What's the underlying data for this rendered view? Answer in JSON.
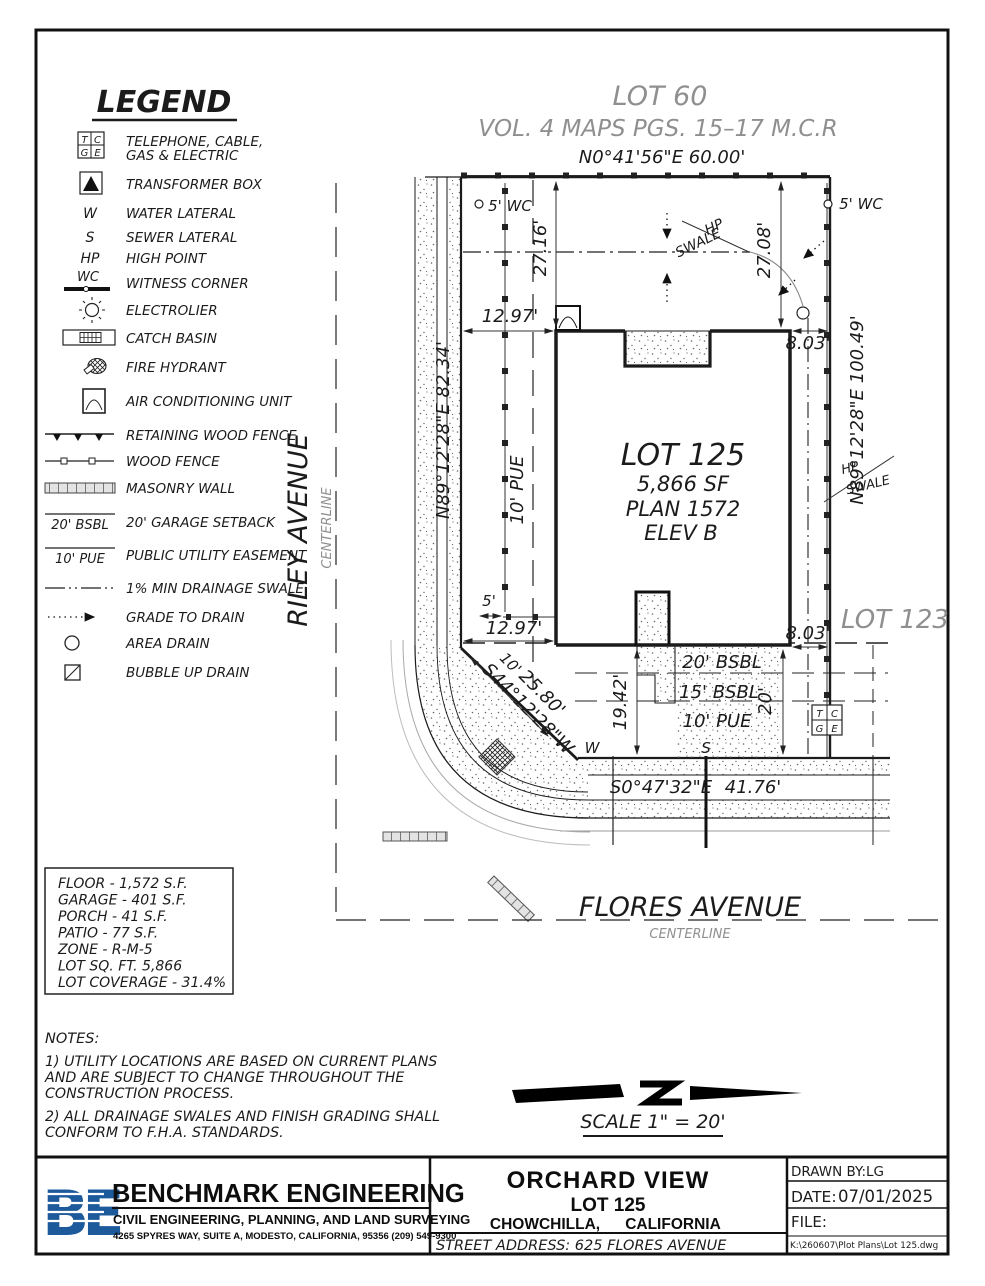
{
  "legend": {
    "title": "LEGEND",
    "tcge": {
      "t": "T",
      "c": "C",
      "g": "G",
      "e": "E"
    },
    "items": [
      {
        "label": "TELEPHONE, CABLE,",
        "label2": "GAS & ELECTRIC"
      },
      {
        "label": "TRANSFORMER BOX"
      },
      {
        "label": "WATER LATERAL",
        "sym": "W"
      },
      {
        "label": "SEWER LATERAL",
        "sym": "S"
      },
      {
        "label": "HIGH POINT",
        "sym": "HP"
      },
      {
        "label": "WITNESS CORNER",
        "sym": "WC"
      },
      {
        "label": "ELECTROLIER"
      },
      {
        "label": "CATCH BASIN"
      },
      {
        "label": "FIRE HYDRANT"
      },
      {
        "label": "AIR CONDITIONING UNIT"
      },
      {
        "label": "RETAINING WOOD FENCE"
      },
      {
        "label": "WOOD FENCE"
      },
      {
        "label": "MASONRY WALL"
      },
      {
        "label": "20' GARAGE SETBACK",
        "sym": "20' BSBL"
      },
      {
        "label": "PUBLIC UTILITY EASEMENT",
        "sym": "10' PUE"
      },
      {
        "label": "1% MIN DRAINAGE SWALE"
      },
      {
        "label": "GRADE TO DRAIN"
      },
      {
        "label": "AREA DRAIN"
      },
      {
        "label": "BUBBLE UP DRAIN"
      }
    ]
  },
  "plan": {
    "lot60": "LOT 60",
    "lot60_sub": "VOL. 4 MAPS PGS. 15–17 M.C.R",
    "north_bearing": "N0°41'56\"E  60.00'",
    "west_bearing": "N89°12'28\"E  82.34'",
    "east_bearing": "N89°12'28\"E  100.49'",
    "south_bearing": "S0°47'32\"E",
    "south_dist": "41.76'",
    "chamfer_offset": "10'",
    "chamfer_dist": "25.80'",
    "chamfer_bearing": "S44°12'28\"W",
    "lot125_name": "LOT 125",
    "lot125_area": "5,866 SF",
    "lot125_plan": "PLAN 1572",
    "lot125_elev": "ELEV B",
    "lot123": "LOT 123",
    "riley": "RILEY AVENUE",
    "riley_sub": "CENTERLINE",
    "flores": "FLORES AVENUE",
    "flores_sub": "CENTERLINE",
    "wc_left": "5' WC",
    "wc_right": "5' WC",
    "dim_2716": "27.16'",
    "dim_2708": "27.08'",
    "dim_1297_top": "12.97'",
    "dim_1297_bot": "12.97'",
    "dim_803_top": "8.03'",
    "dim_803_bot": "8.03'",
    "dim_1942": "19.42'",
    "dim_20": "20'",
    "dim_5": "5'",
    "pue_label": "10' PUE",
    "bsbl20": "20' BSBL",
    "bsbl15": "15' BSBL",
    "pue10": "10' PUE",
    "hp_top": "HP",
    "swale_top": "SWALE",
    "hp_right": "HP",
    "swale_right": "SWALE",
    "w_lateral": "W",
    "s_lateral": "S",
    "tcge": {
      "t": "T",
      "c": "C",
      "g": "G",
      "e": "E"
    }
  },
  "stats": {
    "lines": [
      "FLOOR - 1,572 S.F.",
      "GARAGE - 401 S.F.",
      "PORCH - 41 S.F.",
      "PATIO - 77 S.F.",
      "ZONE - R-M-5",
      "LOT SQ. FT. 5,866",
      "LOT COVERAGE - 31.4%"
    ]
  },
  "notes": {
    "title": "NOTES:",
    "n1_l1": "1) UTILITY LOCATIONS ARE BASED ON CURRENT PLANS",
    "n1_l2": "AND ARE SUBJECT TO CHANGE THROUGHOUT THE",
    "n1_l3": "CONSTRUCTION PROCESS.",
    "n2_l1": "2) ALL DRAINAGE SWALES AND FINISH GRADING SHALL",
    "n2_l2": "CONFORM TO F.H.A. STANDARDS."
  },
  "scale_bar": {
    "label": "SCALE 1\" = 20'"
  },
  "titleblock": {
    "logo": "BE",
    "company": "BENCHMARK ENGINEERING",
    "tagline": "CIVIL ENGINEERING, PLANNING, AND LAND SURVEYING",
    "address": "4265 SPYRES WAY, SUITE A, MODESTO, CALIFORNIA, 95356   (209) 549-9300",
    "project": "ORCHARD VIEW",
    "lot": "LOT 125",
    "city1": "CHOWCHILLA,",
    "city2": "CALIFORNIA",
    "street": "STREET   ADDRESS:  625  FLORES  AVENUE",
    "drawn_by_label": "DRAWN BY:",
    "drawn_by": "LG",
    "date_label": "DATE:",
    "date": "07/01/2025",
    "file_label": "FILE:",
    "file_path": "K:\\260607\\Plot Plans\\Lot 125.dwg"
  },
  "colors": {
    "logo_blue": "#1d5a9b",
    "gray_text": "#8f8f8f"
  }
}
